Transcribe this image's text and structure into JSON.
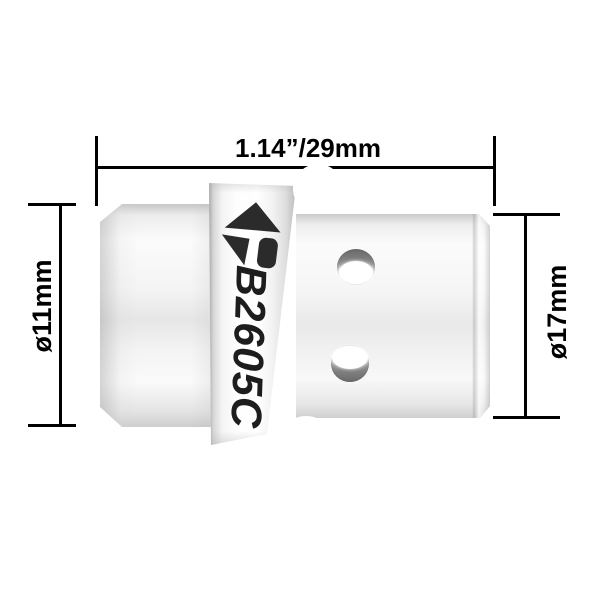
{
  "diagram": {
    "type": "product-dimension-diagram",
    "part_model": "B2605C",
    "dimensions": {
      "overall_width": "1.14”/29mm",
      "left_diameter": "ø11mm",
      "right_diameter": "ø17mm"
    },
    "logo": "upward-arrow-p-brand-mark",
    "colors": {
      "background": "#ffffff",
      "dimension_lines": "#000000",
      "dimension_text": "#000000",
      "part_label_text": "#1d1d1d",
      "logo_fill": "#2b2b2b",
      "body_highlight": "#fdfdfd",
      "body_shadow": "#cccccc",
      "hole_wall": "#707070"
    }
  }
}
